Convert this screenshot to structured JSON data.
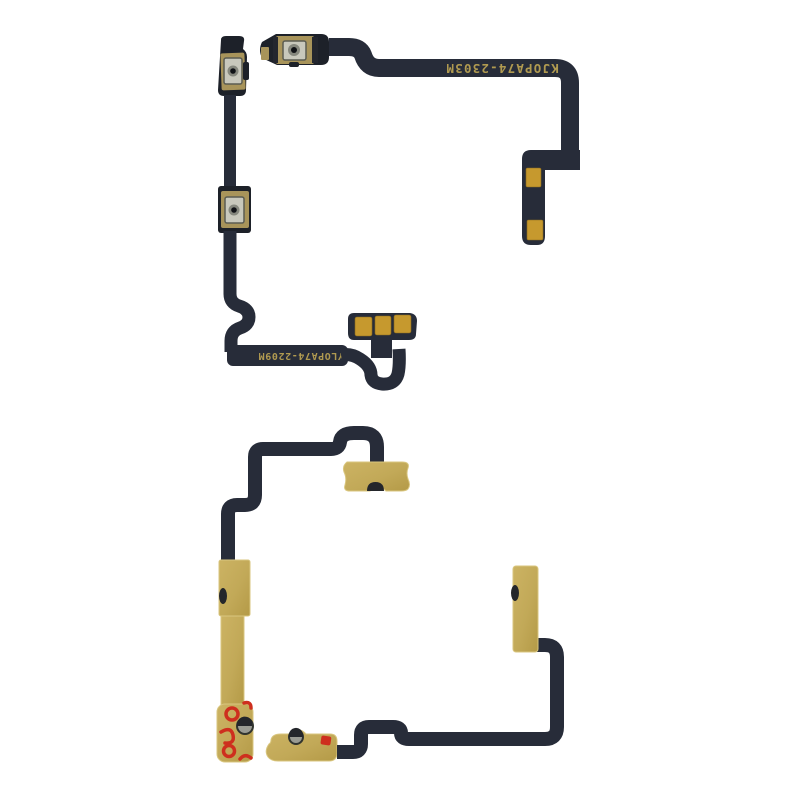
{
  "scene": {
    "kind": "product-photo",
    "subject": "Two phone power/volume side-button flex cables on a white background: front view (top) and rear adhesive view (bottom)",
    "background_color": "#ffffff"
  },
  "front_cable": {
    "top_marking": "KJOPA74-2303M",
    "bottom_marking": "YLOPA74-2209M"
  },
  "back_cable": {
    "visible_markings": ""
  },
  "colors": {
    "flex_ribbon": "#272c39",
    "bracket_dark": "#1d2129",
    "contact_gold": "#c6992e",
    "button_plate_gold": "#a8945a",
    "adhesive_khaki": "#c2a958",
    "adhesive_red": "#ce2f1e",
    "metal_dome_grey": "#9a9b93",
    "marking_text": "#b09a50"
  }
}
